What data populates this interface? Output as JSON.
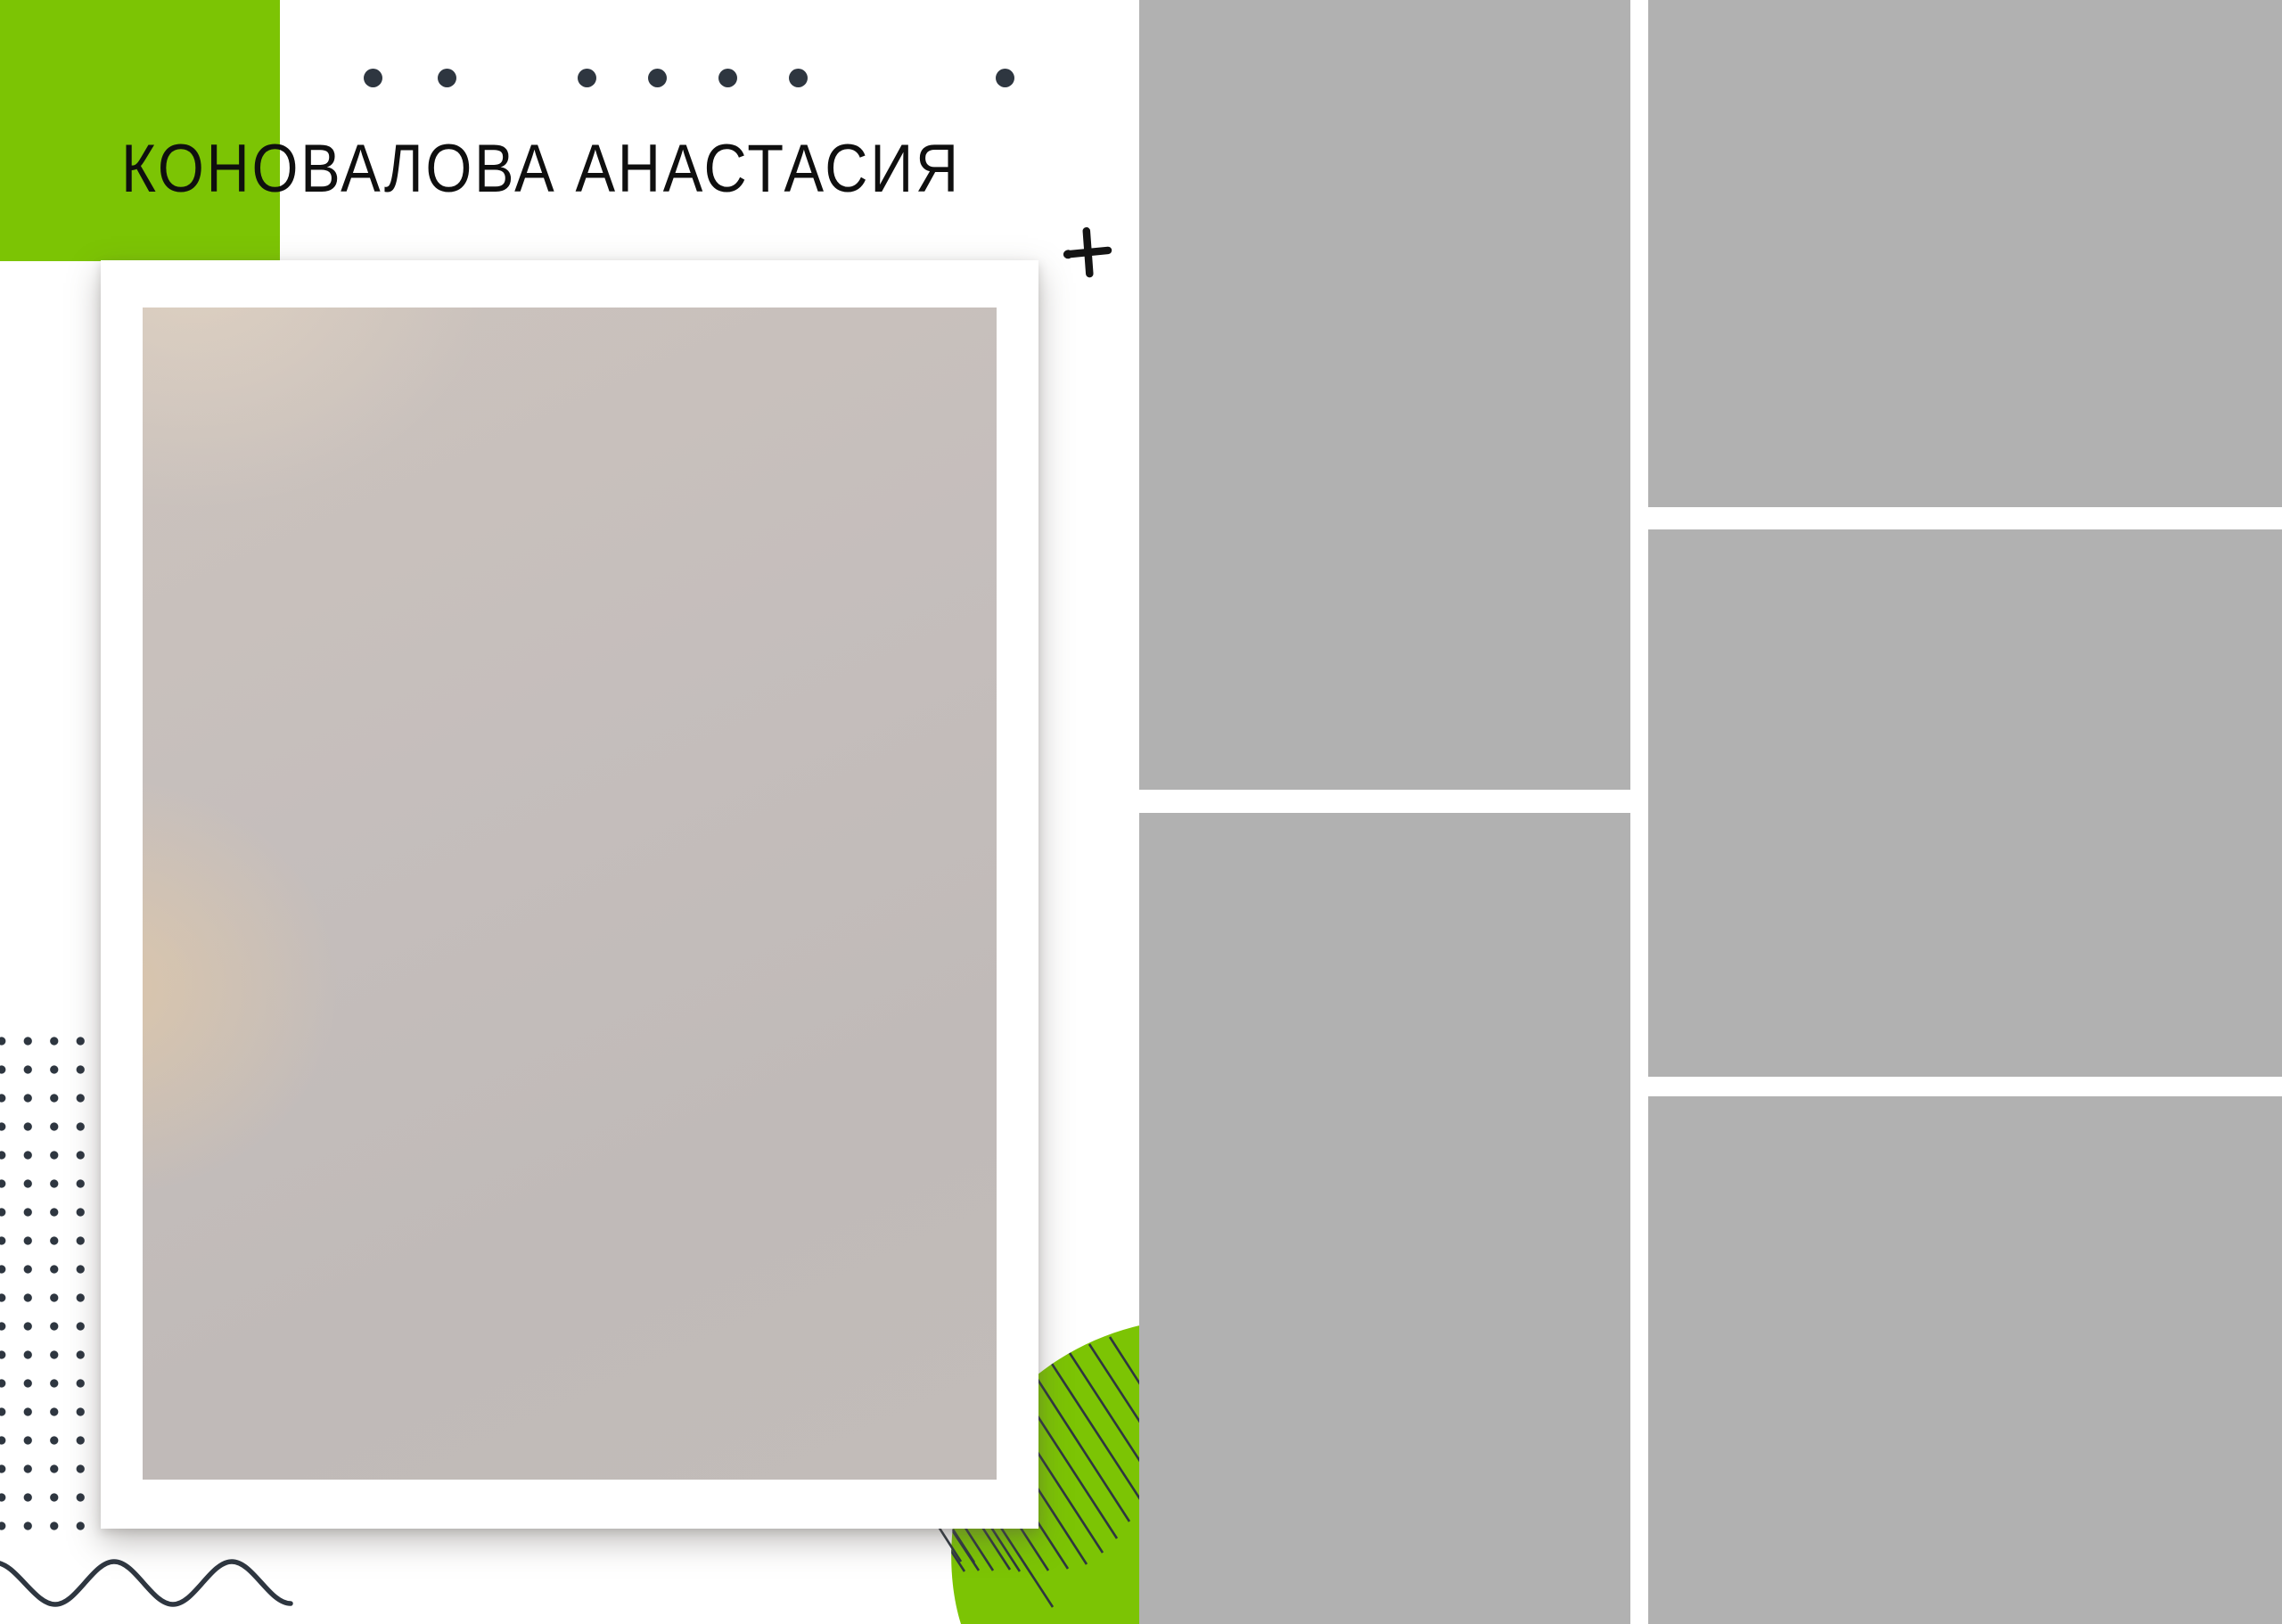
{
  "page": {
    "title": "КОНОВАЛОВА АНАСТАСИЯ"
  },
  "theme": {
    "background": "#ffffff",
    "accent_green": "#7cc404",
    "ink": "#2e3640",
    "title_color": "#0f0f0f",
    "photo_fill": "#c2bcba",
    "slot_fill": "#b1b1b1",
    "frame_fill": "#ffffff"
  },
  "decorations": {
    "top_dot_row_count": 7,
    "dot_grid_columns": 4,
    "dot_grid_rows": 18,
    "icons": [
      "dot-icon",
      "plus-icon",
      "wave-line-icon",
      "hatch-lines-icon",
      "green-blob"
    ]
  },
  "photo_slots": {
    "main_photo": "framed-portrait-placeholder",
    "gray_slots": [
      "middle-top",
      "middle-bottom",
      "right-top",
      "right-middle",
      "right-bottom"
    ]
  }
}
